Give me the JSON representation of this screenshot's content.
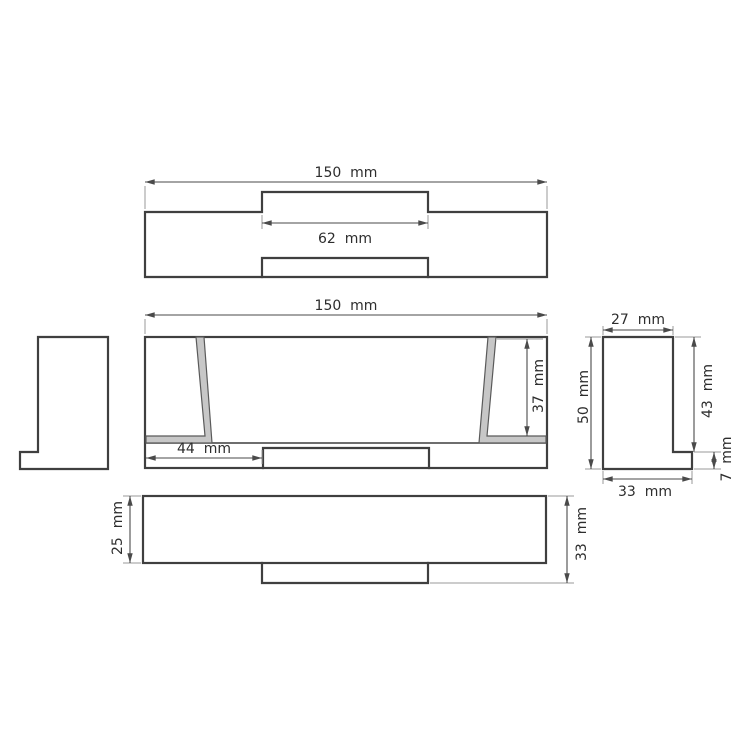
{
  "drawing": {
    "unit": "mm",
    "colors": {
      "outline": "#3f3f3f",
      "dimension": "#4a4a4a",
      "extension": "#9a9a9a",
      "section_fill": "#c7c7c7",
      "section_edge": "#5a5a5a",
      "label_text": "#2d2d2d",
      "background": "#ffffff"
    },
    "views": {
      "top": {
        "dims": {
          "overall_width": {
            "value": 150,
            "label": "150  mm"
          },
          "tab_width": {
            "value": 62,
            "label": "62  mm"
          }
        }
      },
      "front": {
        "dims": {
          "overall_width": {
            "value": 150,
            "label": "150  mm"
          },
          "inner_depth": {
            "value": 37,
            "label": "37  mm"
          },
          "left_inset": {
            "value": 44,
            "label": "44  mm"
          }
        }
      },
      "right_profile": {
        "dims": {
          "top_width": {
            "value": 27,
            "label": "27  mm"
          },
          "overall_height": {
            "value": 50,
            "label": "50  mm"
          },
          "upper_height": {
            "value": 43,
            "label": "43  mm"
          },
          "foot_height": {
            "value": 7,
            "label": "7  mm"
          },
          "bottom_width": {
            "value": 33,
            "label": "33  mm"
          }
        }
      },
      "bottom": {
        "dims": {
          "body_depth": {
            "value": 25,
            "label": "25  mm"
          },
          "overall_depth": {
            "value": 33,
            "label": "33  mm"
          }
        }
      }
    }
  }
}
